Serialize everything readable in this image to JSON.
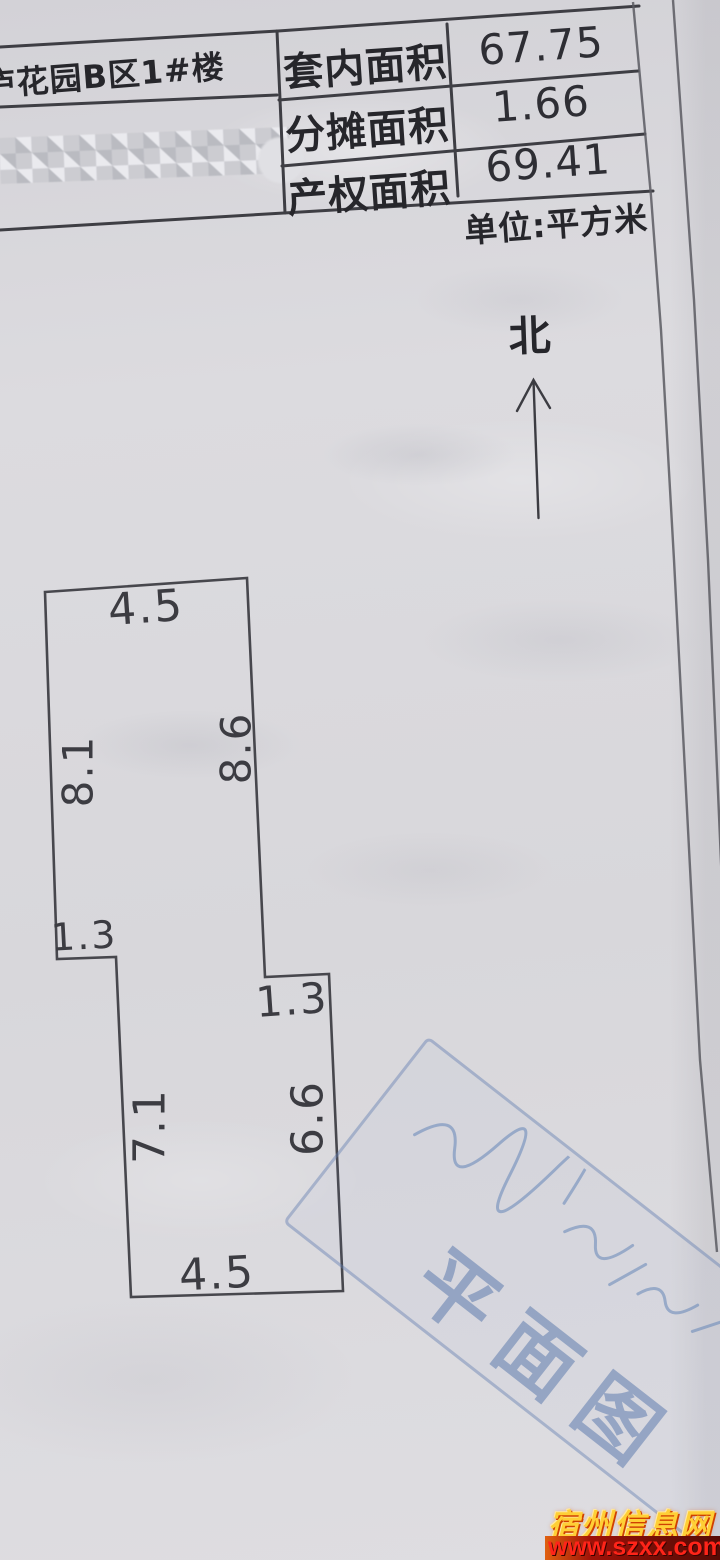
{
  "header": {
    "building_label": "庐花园B区1#楼",
    "rows": [
      {
        "label": "套内面积",
        "value": "67.75"
      },
      {
        "label": "分摊面积",
        "value": "1.66"
      },
      {
        "label": "产权面积",
        "value": "69.41"
      }
    ],
    "unit_note": "单位:平方米"
  },
  "compass": {
    "north_label": "北"
  },
  "floor_plan": {
    "unit": "平方米",
    "dims": {
      "top": "4.5",
      "upper_left": "8.1",
      "upper_right": "8.6",
      "left_step": "1.3",
      "right_step": "1.3",
      "lower_left": "7.1",
      "lower_right": "6.6",
      "bottom": "4.5"
    }
  },
  "stamp": {
    "text": "平面图",
    "color": "#5f7cb0"
  },
  "watermark": {
    "name": "宿州信息网",
    "url": "www.szxx.com.cn",
    "name_color": "#ffcf36",
    "url_color": "#ff2419"
  }
}
